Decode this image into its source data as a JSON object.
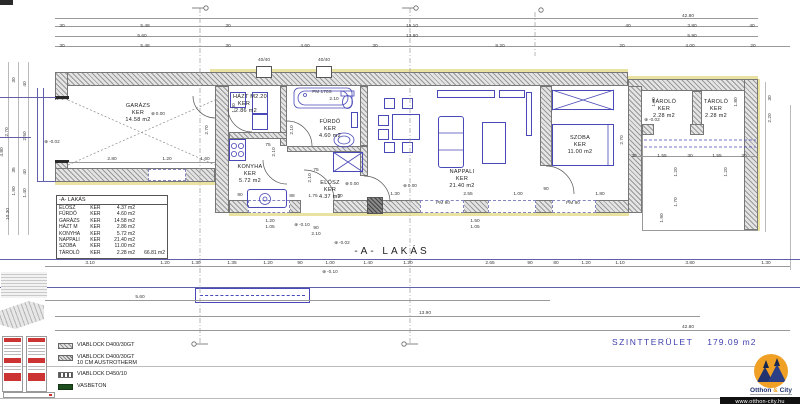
{
  "title": "-A- LAKÁS",
  "summary": {
    "label": "SZINTTERÜLET",
    "value": "179.09  m2"
  },
  "room_table": {
    "header": "-A- LAKÁS",
    "rows": [
      {
        "n": "ELŐSZ",
        "k": "KER",
        "a": "4.37 m2"
      },
      {
        "n": "FÜRDŐ",
        "k": "KER",
        "a": "4.60 m2"
      },
      {
        "n": "GARÁZS",
        "k": "KER",
        "a": "14.58 m2"
      },
      {
        "n": "HÁZT M",
        "k": "KER",
        "a": "2.86 m2"
      },
      {
        "n": "KONYHA",
        "k": "KER",
        "a": "5.72 m2"
      },
      {
        "n": "NAPPALI",
        "k": "KER",
        "a": "21.40 m2"
      },
      {
        "n": "SZOBA",
        "k": "KER",
        "a": "11.00 m2"
      },
      {
        "n": "TÁROLÓ",
        "k": "KER",
        "a": "2.28 m2"
      }
    ],
    "total": "66.81 m2"
  },
  "legend": [
    {
      "swatch": "hatch",
      "label": "VIABLOCK D400/30GT"
    },
    {
      "swatch": "hatch2",
      "label": "VIABLOCK D400/30GT",
      "label2": "10 CM AUSTROTHERM"
    },
    {
      "swatch": "dash",
      "label": "VIABLOCK D450/10"
    },
    {
      "swatch": "green",
      "label": "VASBETON"
    }
  ],
  "logo": {
    "name1": "Otthon",
    "amp": "&",
    "name2": "City",
    "url": "www.otthon-city.hu"
  },
  "colors": {
    "accent_blue": "#4949b8",
    "dim_text": "#3a3a3a",
    "insulation": "#e9e2a0",
    "vasbeton": "#1e4d1e",
    "summary_blue": "#4040ae",
    "logo_orange": "#f0a125",
    "logo_navy": "#20336e"
  },
  "labels": [
    {
      "t": "42.80",
      "x": 688,
      "y": 16,
      "c": "d"
    },
    {
      "t": "30",
      "x": 62,
      "y": 26,
      "c": "d"
    },
    {
      "t": "5.48",
      "x": 145,
      "y": 26,
      "c": "d"
    },
    {
      "t": "30",
      "x": 228,
      "y": 26,
      "c": "d"
    },
    {
      "t": "15.10",
      "x": 412,
      "y": 26,
      "c": "d"
    },
    {
      "t": "40",
      "x": 628,
      "y": 26,
      "c": "d"
    },
    {
      "t": "3.80",
      "x": 692,
      "y": 26,
      "c": "d"
    },
    {
      "t": "40",
      "x": 752,
      "y": 26,
      "c": "d"
    },
    {
      "t": "5.60",
      "x": 142,
      "y": 36,
      "c": "d"
    },
    {
      "t": "13.80",
      "x": 412,
      "y": 36,
      "c": "d"
    },
    {
      "t": "5.90",
      "x": 692,
      "y": 36,
      "c": "d"
    },
    {
      "t": "30",
      "x": 62,
      "y": 46,
      "c": "d"
    },
    {
      "t": "5.48",
      "x": 145,
      "y": 46,
      "c": "d"
    },
    {
      "t": "30",
      "x": 228,
      "y": 46,
      "c": "d"
    },
    {
      "t": "4.60",
      "x": 305,
      "y": 46,
      "c": "d"
    },
    {
      "t": "30",
      "x": 375,
      "y": 46,
      "c": "d"
    },
    {
      "t": "8.20",
      "x": 500,
      "y": 46,
      "c": "d"
    },
    {
      "t": "20",
      "x": 622,
      "y": 46,
      "c": "d"
    },
    {
      "t": "4.00",
      "x": 690,
      "y": 46,
      "c": "d"
    },
    {
      "t": "20",
      "x": 753,
      "y": 46,
      "c": "d"
    },
    {
      "t": "40/40",
      "x": 264,
      "y": 60,
      "c": "d"
    },
    {
      "t": "40/40",
      "x": 324,
      "y": 60,
      "c": "d"
    },
    {
      "t": "GARÁZS",
      "x": 138,
      "y": 106,
      "c": "room"
    },
    {
      "t": "KER",
      "x": 138,
      "y": 113,
      "c": "room"
    },
    {
      "t": "14.58  m2",
      "x": 138,
      "y": 120,
      "c": "room"
    },
    {
      "t": "HÁZT  M2.20",
      "x": 250,
      "y": 97,
      "c": "room"
    },
    {
      "t": "KER",
      "x": 244,
      "y": 104,
      "c": "room"
    },
    {
      "t": "2.86  m2",
      "x": 246,
      "y": 111,
      "c": "room"
    },
    {
      "t": "FÜRDŐ",
      "x": 330,
      "y": 122,
      "c": "room"
    },
    {
      "t": "KER",
      "x": 330,
      "y": 129,
      "c": "room"
    },
    {
      "t": "4.60  m2",
      "x": 330,
      "y": 136,
      "c": "room"
    },
    {
      "t": "KONYHA",
      "x": 250,
      "y": 167,
      "c": "room"
    },
    {
      "t": "KER",
      "x": 250,
      "y": 174,
      "c": "room"
    },
    {
      "t": "5.72  m2",
      "x": 250,
      "y": 181,
      "c": "room"
    },
    {
      "t": "ELŐSZ",
      "x": 330,
      "y": 183,
      "c": "room"
    },
    {
      "t": "KER",
      "x": 330,
      "y": 190,
      "c": "room"
    },
    {
      "t": "4.37  m2",
      "x": 330,
      "y": 197,
      "c": "room"
    },
    {
      "t": "NAPPALI",
      "x": 462,
      "y": 172,
      "c": "room"
    },
    {
      "t": "KER",
      "x": 462,
      "y": 179,
      "c": "room"
    },
    {
      "t": "21.40  m2",
      "x": 462,
      "y": 186,
      "c": "room"
    },
    {
      "t": "SZOBA",
      "x": 580,
      "y": 138,
      "c": "room"
    },
    {
      "t": "KER",
      "x": 580,
      "y": 145,
      "c": "room"
    },
    {
      "t": "11.00  m2",
      "x": 580,
      "y": 152,
      "c": "room"
    },
    {
      "t": "TÁROLÓ",
      "x": 664,
      "y": 102,
      "c": "room"
    },
    {
      "t": "KER",
      "x": 664,
      "y": 109,
      "c": "room"
    },
    {
      "t": "2.28  m2",
      "x": 664,
      "y": 116,
      "c": "room"
    },
    {
      "t": "TÁROLÓ",
      "x": 716,
      "y": 102,
      "c": "room"
    },
    {
      "t": "KER",
      "x": 716,
      "y": 109,
      "c": "room"
    },
    {
      "t": "2.28  m2",
      "x": 716,
      "y": 116,
      "c": "room"
    },
    {
      "t": "FM 170S",
      "x": 322,
      "y": 92,
      "c": "d"
    },
    {
      "t": "2.10",
      "x": 334,
      "y": 99,
      "c": "d"
    },
    {
      "t": "2.80",
      "x": 112,
      "y": 159,
      "c": "d"
    },
    {
      "t": "1.20",
      "x": 167,
      "y": 159,
      "c": "d"
    },
    {
      "t": "1.60",
      "x": 205,
      "y": 159,
      "c": "d"
    },
    {
      "t": "2.70",
      "x": 207,
      "y": 130,
      "c": "r"
    },
    {
      "t": "30",
      "x": 14,
      "y": 80,
      "c": "r"
    },
    {
      "t": "40",
      "x": 25,
      "y": 84,
      "c": "r"
    },
    {
      "t": "2.70",
      "x": 7,
      "y": 132,
      "c": "r"
    },
    {
      "t": "2.50",
      "x": 25,
      "y": 136,
      "c": "r"
    },
    {
      "t": "4.80",
      "x": 2,
      "y": 152,
      "c": "r"
    },
    {
      "t": "35",
      "x": 14,
      "y": 170,
      "c": "r"
    },
    {
      "t": "40",
      "x": 25,
      "y": 172,
      "c": "r"
    },
    {
      "t": "1.90",
      "x": 14,
      "y": 191,
      "c": "r"
    },
    {
      "t": "1.40",
      "x": 25,
      "y": 193,
      "c": "r"
    },
    {
      "t": "10.30",
      "x": 8,
      "y": 214,
      "c": "r"
    },
    {
      "t": "1.30",
      "x": 234,
      "y": 108,
      "c": "r"
    },
    {
      "t": "2.10",
      "x": 292,
      "y": 130,
      "c": "r"
    },
    {
      "t": "75",
      "x": 268,
      "y": 145,
      "c": "d"
    },
    {
      "t": "2.10",
      "x": 274,
      "y": 152,
      "c": "r"
    },
    {
      "t": "75",
      "x": 316,
      "y": 170,
      "c": "d"
    },
    {
      "t": "2.10",
      "x": 310,
      "y": 178,
      "c": "r"
    },
    {
      "t": "90",
      "x": 240,
      "y": 195,
      "c": "d"
    },
    {
      "t": "88",
      "x": 292,
      "y": 196,
      "c": "d"
    },
    {
      "t": "1.75",
      "x": 313,
      "y": 196,
      "c": "d"
    },
    {
      "t": "50",
      "x": 340,
      "y": 196,
      "c": "d"
    },
    {
      "t": "1.30",
      "x": 395,
      "y": 194,
      "c": "d"
    },
    {
      "t": "PM 90",
      "x": 443,
      "y": 203,
      "c": "d"
    },
    {
      "t": "2.55",
      "x": 468,
      "y": 194,
      "c": "d"
    },
    {
      "t": "1.00",
      "x": 518,
      "y": 194,
      "c": "d"
    },
    {
      "t": "90",
      "x": 546,
      "y": 189,
      "c": "d"
    },
    {
      "t": "PM 90",
      "x": 573,
      "y": 203,
      "c": "d"
    },
    {
      "t": "1.80",
      "x": 600,
      "y": 194,
      "c": "d"
    },
    {
      "t": "2.70",
      "x": 622,
      "y": 140,
      "c": "r"
    },
    {
      "t": "1.20",
      "x": 270,
      "y": 221,
      "c": "d"
    },
    {
      "t": "1.05",
      "x": 270,
      "y": 227,
      "c": "d"
    },
    {
      "t": "90",
      "x": 316,
      "y": 228,
      "c": "d"
    },
    {
      "t": "2.10",
      "x": 316,
      "y": 234,
      "c": "d"
    },
    {
      "t": "1.50",
      "x": 475,
      "y": 221,
      "c": "d"
    },
    {
      "t": "1.05",
      "x": 475,
      "y": 227,
      "c": "d"
    },
    {
      "t": "30",
      "x": 634,
      "y": 156,
      "c": "d"
    },
    {
      "t": "1.55",
      "x": 662,
      "y": 156,
      "c": "d"
    },
    {
      "t": "30",
      "x": 690,
      "y": 156,
      "c": "d"
    },
    {
      "t": "1.55",
      "x": 717,
      "y": 156,
      "c": "d"
    },
    {
      "t": "30",
      "x": 744,
      "y": 156,
      "c": "d"
    },
    {
      "t": "1.80",
      "x": 654,
      "y": 102,
      "c": "r"
    },
    {
      "t": "1.80",
      "x": 736,
      "y": 102,
      "c": "r"
    },
    {
      "t": "1.20",
      "x": 676,
      "y": 172,
      "c": "r"
    },
    {
      "t": "1.20",
      "x": 726,
      "y": 172,
      "c": "r"
    },
    {
      "t": "1.70",
      "x": 676,
      "y": 202,
      "c": "r"
    },
    {
      "t": "1.90",
      "x": 662,
      "y": 218,
      "c": "r"
    },
    {
      "t": "30",
      "x": 770,
      "y": 98,
      "c": "r"
    },
    {
      "t": "2.20",
      "x": 770,
      "y": 118,
      "c": "r"
    },
    {
      "t": "0.00",
      "x": 158,
      "y": 114,
      "c": "lvl"
    },
    {
      "t": "-0.02",
      "x": 52,
      "y": 142,
      "c": "lvl"
    },
    {
      "t": "0.00",
      "x": 352,
      "y": 184,
      "c": "lvl"
    },
    {
      "t": "0.00",
      "x": 410,
      "y": 186,
      "c": "lvl"
    },
    {
      "t": "-0.02",
      "x": 652,
      "y": 120,
      "c": "lvl"
    },
    {
      "t": "-0.10",
      "x": 302,
      "y": 225,
      "c": "lvl"
    },
    {
      "t": "-0.02",
      "x": 342,
      "y": 243,
      "c": "lvl"
    },
    {
      "t": "-0.10",
      "x": 330,
      "y": 272,
      "c": "lvl"
    },
    {
      "t": "3.10",
      "x": 90,
      "y": 263,
      "c": "d"
    },
    {
      "t": "1.20",
      "x": 165,
      "y": 263,
      "c": "d"
    },
    {
      "t": "1.30",
      "x": 196,
      "y": 263,
      "c": "d"
    },
    {
      "t": "1.35",
      "x": 232,
      "y": 263,
      "c": "d"
    },
    {
      "t": "1.20",
      "x": 268,
      "y": 263,
      "c": "d"
    },
    {
      "t": "90",
      "x": 300,
      "y": 263,
      "c": "d"
    },
    {
      "t": "1.00",
      "x": 330,
      "y": 263,
      "c": "d"
    },
    {
      "t": "1.40",
      "x": 368,
      "y": 263,
      "c": "d"
    },
    {
      "t": "1.20",
      "x": 408,
      "y": 263,
      "c": "d"
    },
    {
      "t": "2.65",
      "x": 490,
      "y": 263,
      "c": "d"
    },
    {
      "t": "90",
      "x": 530,
      "y": 263,
      "c": "d"
    },
    {
      "t": "80",
      "x": 556,
      "y": 263,
      "c": "d"
    },
    {
      "t": "1.20",
      "x": 586,
      "y": 263,
      "c": "d"
    },
    {
      "t": "1.10",
      "x": 620,
      "y": 263,
      "c": "d"
    },
    {
      "t": "3.80",
      "x": 690,
      "y": 263,
      "c": "d"
    },
    {
      "t": "1.30",
      "x": 766,
      "y": 263,
      "c": "d"
    },
    {
      "t": "5.60",
      "x": 140,
      "y": 297,
      "c": "d"
    },
    {
      "t": "13.90",
      "x": 425,
      "y": 313,
      "c": "d"
    },
    {
      "t": "42.80",
      "x": 688,
      "y": 327,
      "c": "d"
    },
    {
      "t": "-A-  LAKÁS",
      "x": 392,
      "y": 252,
      "c": "big"
    }
  ]
}
